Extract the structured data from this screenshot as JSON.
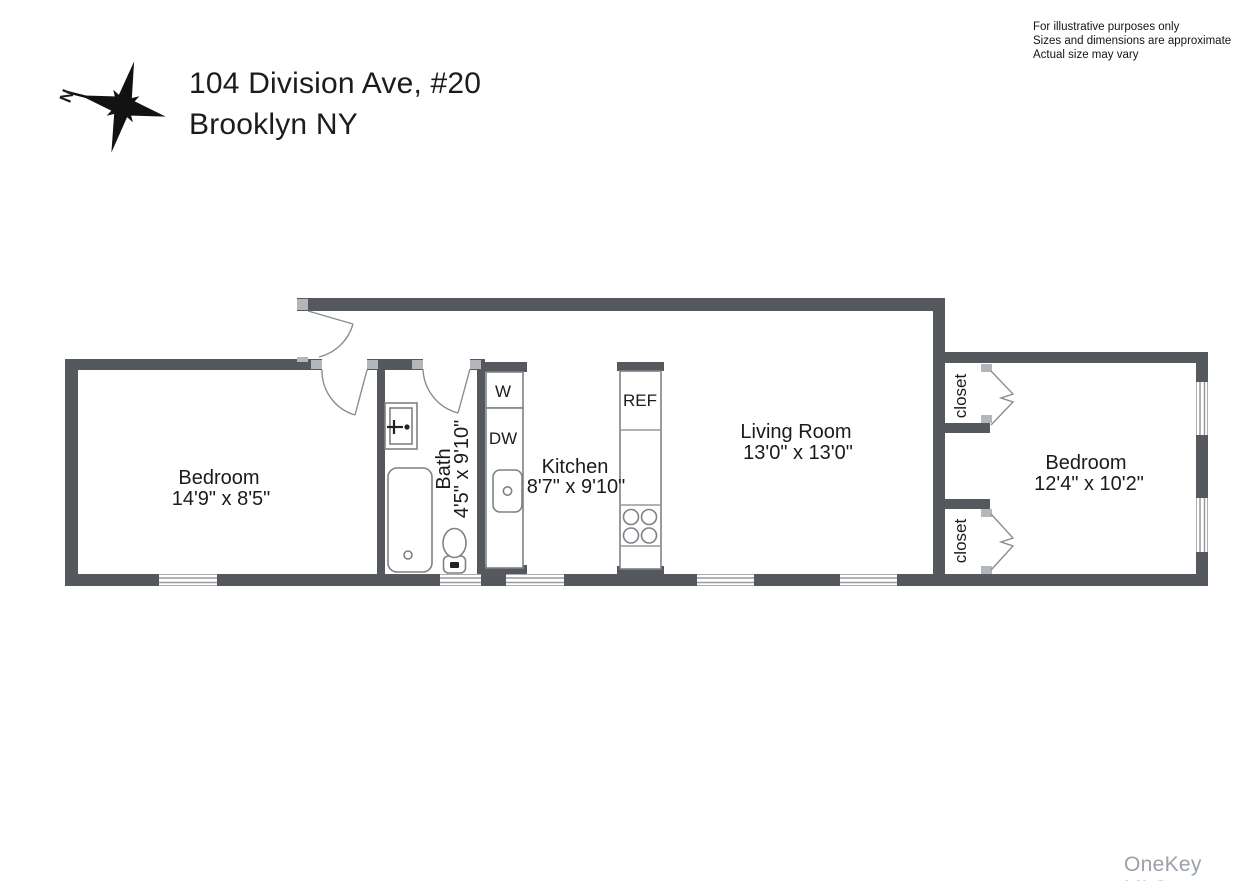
{
  "header": {
    "address_line1": "104 Division Ave, #20",
    "address_line2": "Brooklyn NY",
    "compass_label": "N"
  },
  "disclaimer": {
    "line1": "For illustrative purposes only",
    "line2": "Sizes and dimensions are approximate",
    "line3": "Actual size may vary"
  },
  "floorplan": {
    "rooms": {
      "bedroom_left": {
        "name": "Bedroom",
        "dims": "14'9\" x 8'5\""
      },
      "bath": {
        "name": "Bath",
        "dims": "4'5\" x 9'10\""
      },
      "kitchen": {
        "name": "Kitchen",
        "dims": "8'7\" x 9'10\""
      },
      "living_room": {
        "name": "Living Room",
        "dims": "13'0\" x 13'0\""
      },
      "bedroom_right": {
        "name": "Bedroom",
        "dims": "12'4\" x 10'2\""
      },
      "closet_top": {
        "name": "closet"
      },
      "closet_bottom": {
        "name": "closet"
      }
    },
    "appliances": {
      "washer": "W",
      "dishwasher": "DW",
      "refrigerator": "REF"
    }
  },
  "watermark": "OneKey MLS",
  "colors": {
    "wall": "#55585d",
    "jamb": "#b3b6bb",
    "fixture_outline": "#7e8186",
    "text": "#1b1b1b",
    "watermark": "#9aa1a9"
  }
}
